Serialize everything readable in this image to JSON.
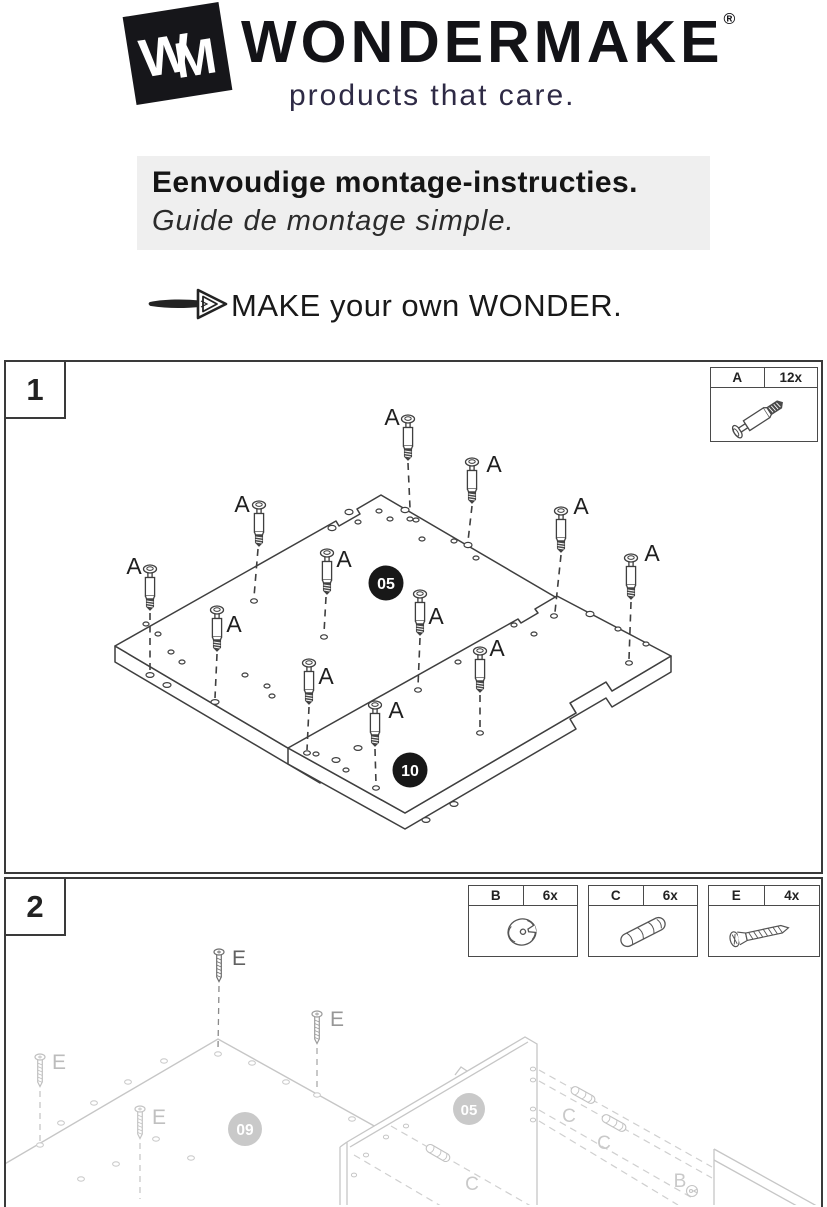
{
  "brand": {
    "monogram_w": "W",
    "monogram_m": "M",
    "name": "WONDERMAKE",
    "registered": "®",
    "tagline": "products that care."
  },
  "intro": {
    "heading_nl": "Eenvoudige montage-instructies.",
    "heading_fr": "Guide de montage simple.",
    "slogan": "MAKE your own WONDER."
  },
  "steps": [
    {
      "number": "1",
      "fastener_label": "A",
      "parts": [
        {
          "label": "A",
          "quantity": "12x",
          "name": "cam-bolt"
        }
      ],
      "panel_badges": [
        "05",
        "10"
      ]
    },
    {
      "number": "2",
      "fastener_labels": {
        "b": "B",
        "c": "C",
        "e": "E"
      },
      "parts": [
        {
          "label": "B",
          "quantity": "6x",
          "name": "cam-lock"
        },
        {
          "label": "C",
          "quantity": "6x",
          "name": "wooden-dowel"
        },
        {
          "label": "E",
          "quantity": "4x",
          "name": "wood-screw"
        }
      ],
      "panel_badges": [
        "09",
        "05"
      ]
    }
  ],
  "colors": {
    "tagline": "#2e2a45",
    "banner_bg": "#efefef",
    "diagram_line": "#3f3f3f",
    "diagram_faded": "#c6c6c6",
    "badge_dark": "#181818",
    "badge_faded": "#c9c9c9"
  }
}
